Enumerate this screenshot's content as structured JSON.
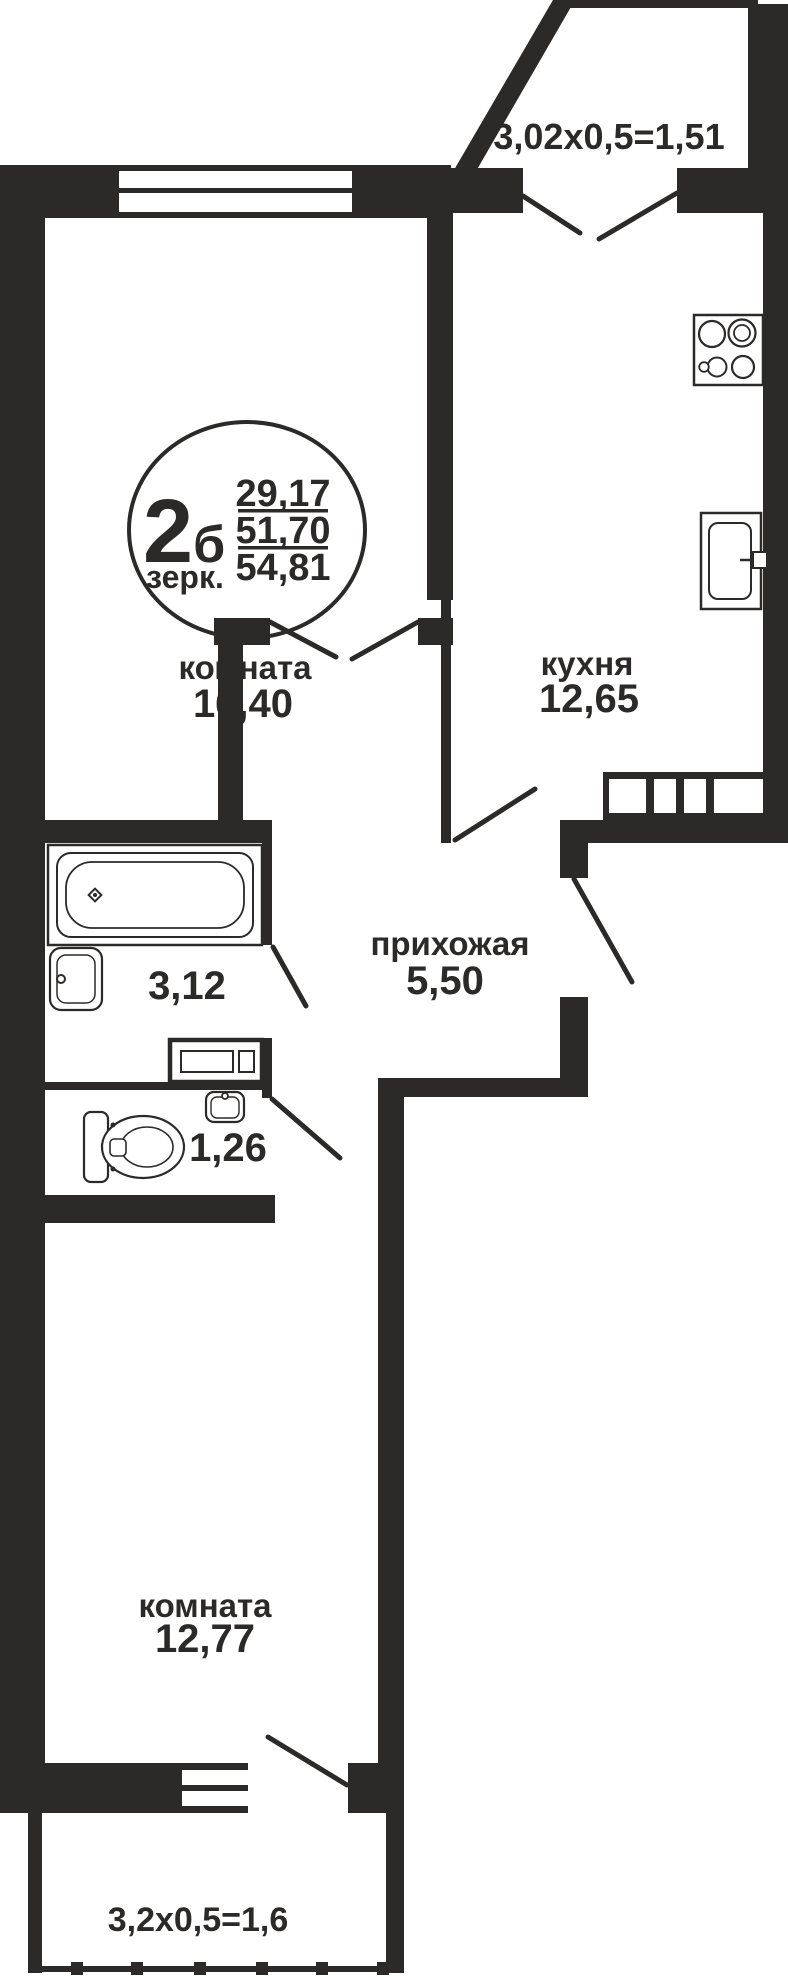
{
  "plan": {
    "logo": {
      "type_number": "2",
      "type_letter": "б",
      "mirror_label": "зерк.",
      "living_area": "29,17",
      "floor_area": "51,70",
      "total_area": "54,81"
    },
    "rooms": {
      "living": {
        "label": "комната",
        "area": "16,40"
      },
      "kitchen": {
        "label": "кухня",
        "area": "12,65"
      },
      "hallway": {
        "label": "прихожая",
        "area": "5,50"
      },
      "bathroom": {
        "area": "3,12"
      },
      "wc": {
        "area": "1,26"
      },
      "bedroom": {
        "label": "комната",
        "area": "12,77"
      }
    },
    "balconies": {
      "top": {
        "dimensions": "3,02x0,5=1,51"
      },
      "bottom": {
        "dimensions": "3,2x0,5=1,6"
      }
    },
    "colors": {
      "wall": "#2b2a28",
      "background": "#ffffff"
    }
  }
}
